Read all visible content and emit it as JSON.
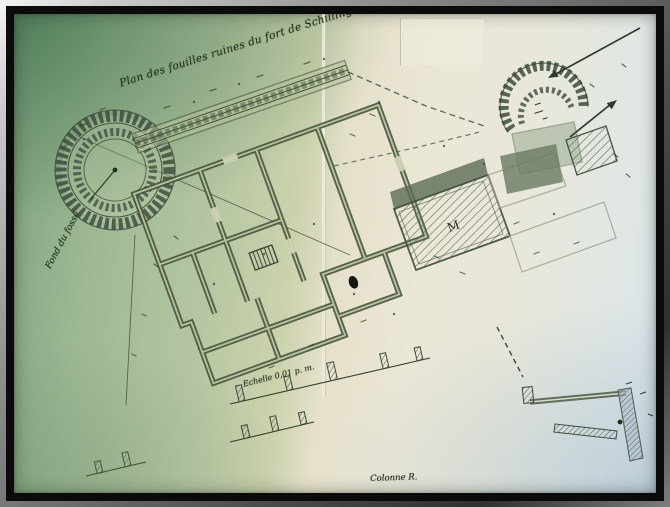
{
  "annotations": {
    "title": "Plan des fouilles ruines du fort de Schilling",
    "left_note": "Fond du fossé",
    "scale_note": "Echelle 0,01 p. m.",
    "column_note": "Colonne R.",
    "room_label": "M"
  },
  "colors": {
    "paper_green": "#9cb893",
    "paper_cream": "#ebe7d6",
    "paper_blue_white": "#dbe4ea",
    "ink": "#33402f",
    "wall_fill": "#46553e",
    "frame_black": "#0b0b0c"
  }
}
